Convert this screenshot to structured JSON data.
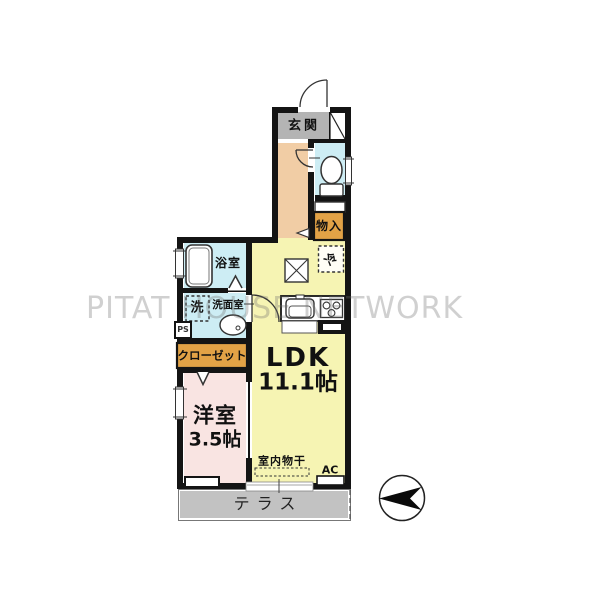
{
  "watermark": {
    "text": "PITAT HOUSE NETWORK"
  },
  "compass": {
    "icon": "north-arrow",
    "direction": "pointing-left"
  },
  "rooms": {
    "genkan": {
      "label": "玄関"
    },
    "monoire": {
      "label": "物入"
    },
    "refrigerator": {
      "label": "冷"
    },
    "bathroom": {
      "label": "浴室"
    },
    "laundry": {
      "label": "洗"
    },
    "washroom": {
      "label": "洗面室"
    },
    "pipe_space": {
      "label": "PS"
    },
    "closet": {
      "label": "クローゼット"
    },
    "ldk": {
      "label": "LDK",
      "size": "11.1帖"
    },
    "western_room": {
      "label": "洋室",
      "size": "3.5帖"
    },
    "indoor_drying": {
      "label": "室内物干"
    },
    "ac": {
      "label": "AC"
    },
    "terrace": {
      "label": "テラス"
    }
  },
  "colors": {
    "wall": "#141414",
    "genkan_gray": "#b4b4b4",
    "hall_peach": "#f1cda5",
    "wet_cyan": "#cdedf4",
    "storage_orange": "#e2a246",
    "ldk_yellow": "#f6f4b3",
    "room_pink": "#f9e4e2",
    "terrace_gray": "#c2c2c2"
  }
}
